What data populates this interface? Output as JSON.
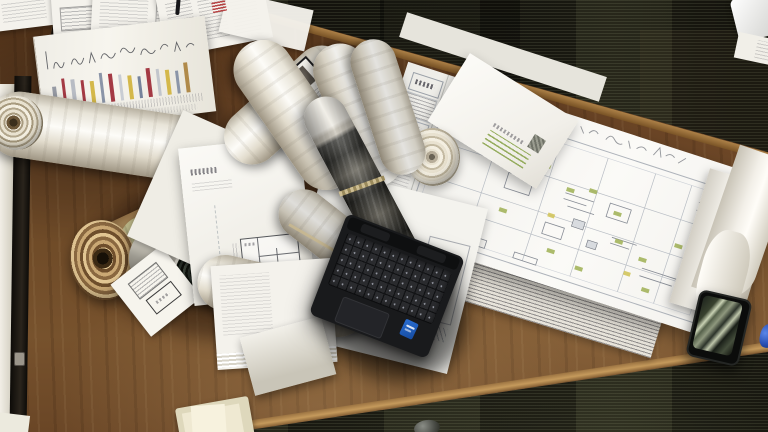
{
  "meta": {
    "type": "photograph",
    "description": "Top-down photograph of a wooden architect's desk on dark office carpet, covered with rolled-up drawings, folded blueprints, a large floor-plan sheet with an envelope on it, a black open laptop with an Intel sticker, and a smartphone near the desk edge.",
    "width_px": 768,
    "height_px": 432
  },
  "palette": {
    "carpet_dark": "#17160f",
    "carpet_highlight": "#8a9468",
    "desk_wood_mid": "#6b4526",
    "desk_wood_light": "#a5793f",
    "desk_wood_dark": "#4f3017",
    "paper_white": "#f4f2ec",
    "paper_cream": "#e8e2c8",
    "kraft_brown": "#b8946a",
    "dark_roll_green": "#1f2a1f",
    "laptop_body": "#191a1c",
    "intel_sticker_blue": "#2a6fd4",
    "phone_black": "#0b0c0b",
    "phone_reflection_green": "#c9d2b4",
    "stamp_red": "#b13434",
    "plan_line_gray": "#9aa0a8",
    "plan_highlight_green": "#a3b45c",
    "blue_object": "#2a50b4"
  },
  "gantt_stripe_colors": [
    "#979ba4",
    "#a43a44",
    "#b8bcc4",
    "#a43a44",
    "#d4b84a",
    "#8b95a8",
    "#a43a44",
    "#c9cdd3",
    "#d4b84a",
    "#76839b",
    "#a43a44",
    "#c2c6cc",
    "#d4b84a",
    "#8b95a8",
    "#b08a4a"
  ],
  "objects": {
    "desk": "wooden desk slab set diagonally across frame",
    "carpet": "dark striated carpet tiles",
    "gantt_sheet": "white sheet with colored vertical bars and handwritten notes",
    "top_papers": "loose printed pages overhanging the top desk edge",
    "left_roll": "large rolled drawing lying across the left side",
    "kraft_roll": "brown kraft-paper roll with visible spiral end",
    "dark_roll": "dark green rolled print with white outer wrap",
    "label_roll": "rolled sheet with a black-framed photo label",
    "marble_tube": "tube wrapped in dark marbled paper",
    "logo_sheet": "flat sheet with small logo and mini floor plan",
    "blueprint": "large floor-plan sheet with title block and green highlight notes",
    "envelope": "white envelope with stamp and green address lines",
    "white_spiral": "end of a white rolled tube seen face-on",
    "curled_stack": "stack of curled sheet edges at right",
    "laptop": "black laptop, keyboard and touchpad visible, Intel sticker on palm rest",
    "phone": "black smartphone with green window reflections on screen",
    "cream_stack": "small cream paper stack at bottom edge",
    "pebble": "small gray object at bottom edge",
    "blue_object": "small blue object cut by right edge",
    "wall_strip": "light cabinet edge along left side"
  }
}
